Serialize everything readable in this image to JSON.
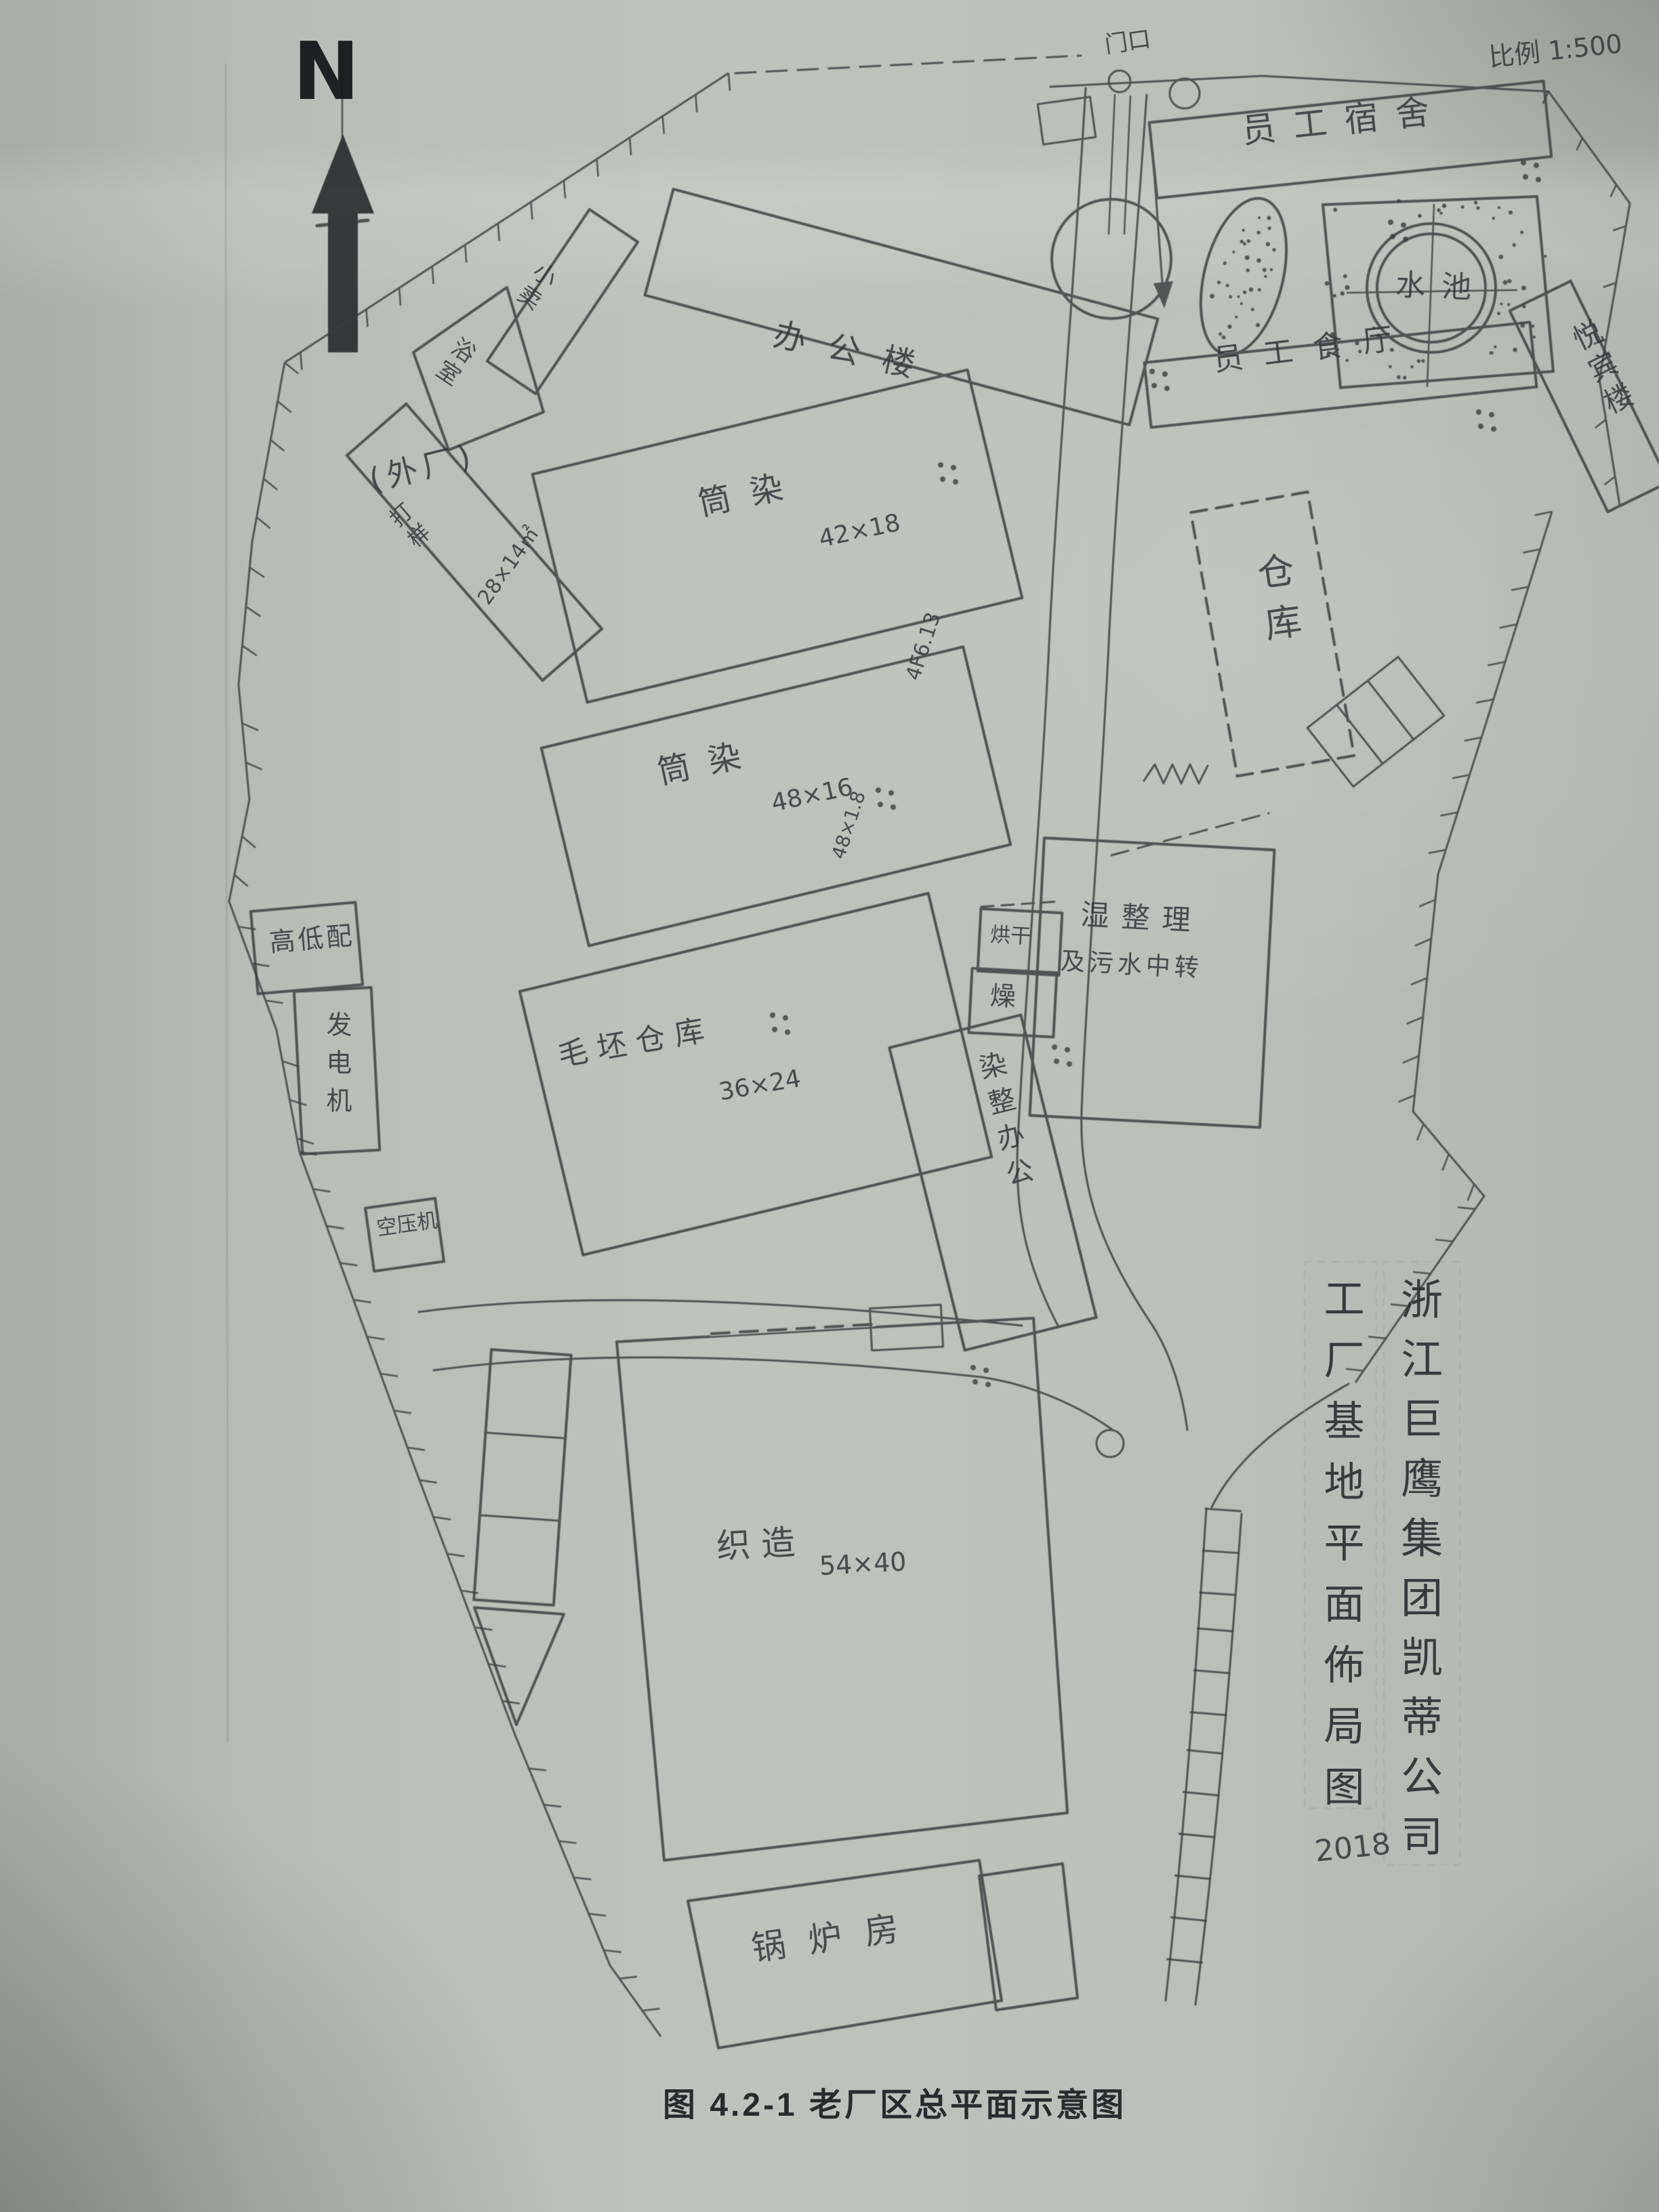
{
  "page": {
    "north_label": "N",
    "scale_label": "比例 1:500",
    "gate_label": "门口",
    "caption": "图 4.2-1 老厂区总平面示意图"
  },
  "title_block": {
    "company_column": "浙江巨鹰集团凯蒂公司",
    "drawing_column": "工厂基地平面佈局图",
    "year": "2018"
  },
  "buildings": {
    "dormitory": {
      "label": "员工宿舍"
    },
    "pool": {
      "label": "水池"
    },
    "vip_building": {
      "label": "悦宾楼"
    },
    "canteen": {
      "label": "员工食厅"
    },
    "office": {
      "label": "办公楼"
    },
    "shop": {
      "label": "小卖"
    },
    "bathhouse": {
      "label": "浴室"
    },
    "outer_factory": {
      "label": "(外厂)",
      "sub_label": "打样",
      "dim": "28×14㎡"
    },
    "dye_shop_1": {
      "label": "筒染",
      "dim": "42×18"
    },
    "dye_shop_2": {
      "label": "筒染",
      "dim": "48×16"
    },
    "raw_warehouse": {
      "label": "毛坯仓库",
      "dim": "36×24"
    },
    "power_distribution": {
      "label": "高低配"
    },
    "generator": {
      "label": "发电机"
    },
    "air_compressor": {
      "label": "空压机"
    },
    "storehouse": {
      "label": "仓库"
    },
    "wet_finishing": {
      "label": "湿整理",
      "label2": "及污水中转"
    },
    "drying_room": {
      "label": "烘干"
    },
    "drying_room_2": {
      "label": "燥"
    },
    "dye_office": {
      "label": "染整办公"
    },
    "weaving_workshop": {
      "label": "织造",
      "dim": "54×40"
    },
    "boiler_house": {
      "label": "锅炉房"
    }
  },
  "annotations": {
    "elev_mark_1": "4F6.13",
    "elev_mark_2": "48×1.8"
  }
}
